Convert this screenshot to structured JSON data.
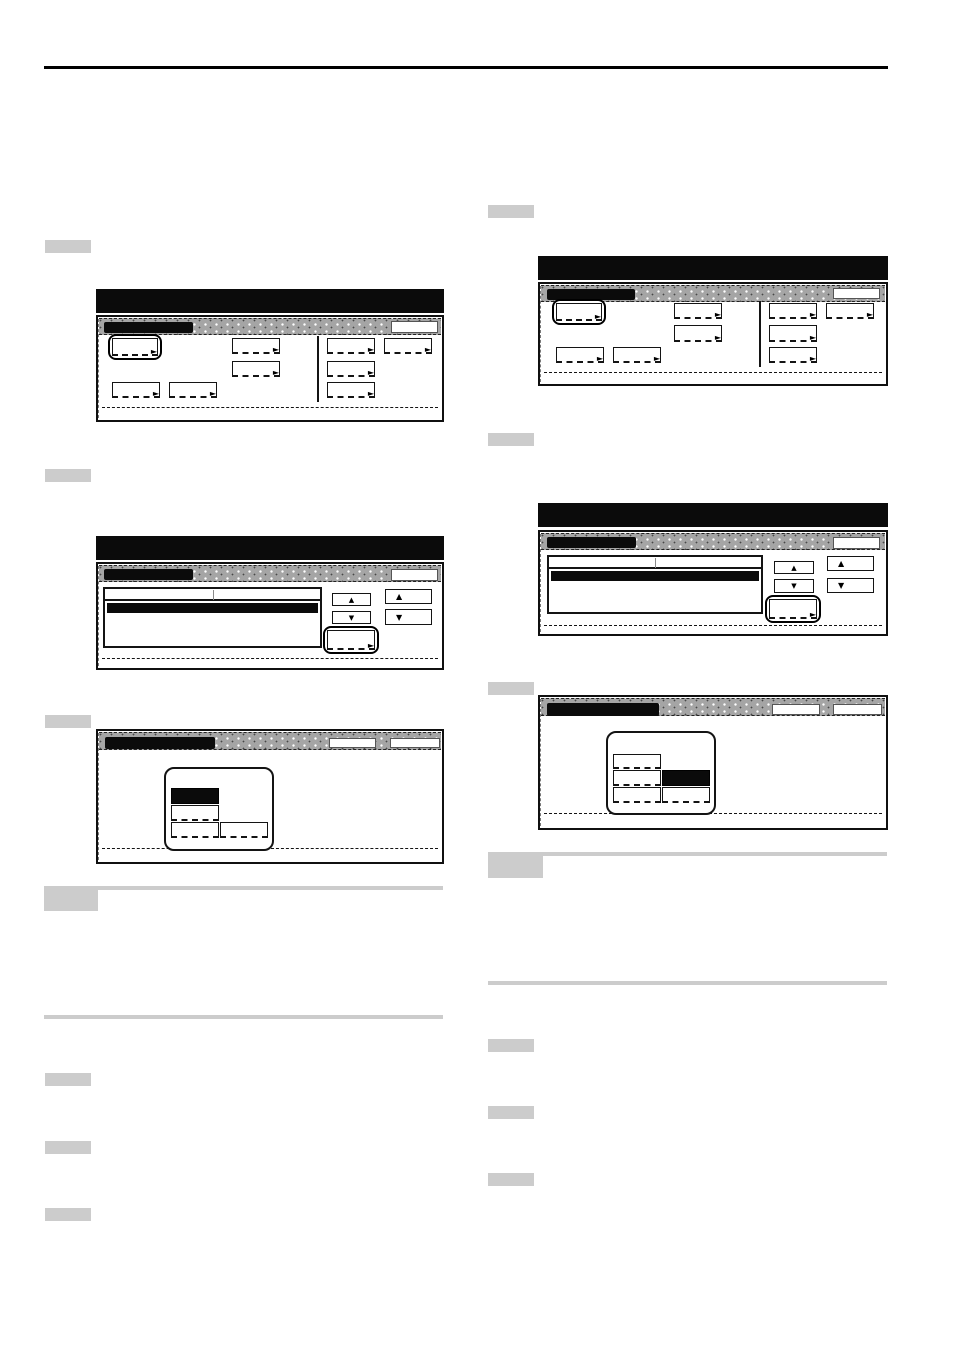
{
  "icons": {
    "key_arrow": "►",
    "scroll_up": "▲",
    "scroll_down": "▼"
  },
  "colors": {
    "page_bg": "#ffffff",
    "titlebar_black": "#0b0b0b",
    "header_dotted_gray": "#a5a5a5",
    "key_border_black": "#141414",
    "selected_key_black": "#0b0b0b",
    "step_marker_gray": "#cccccc",
    "note_rule_gray": "#cccccc",
    "page_rule_black": "#000000"
  }
}
